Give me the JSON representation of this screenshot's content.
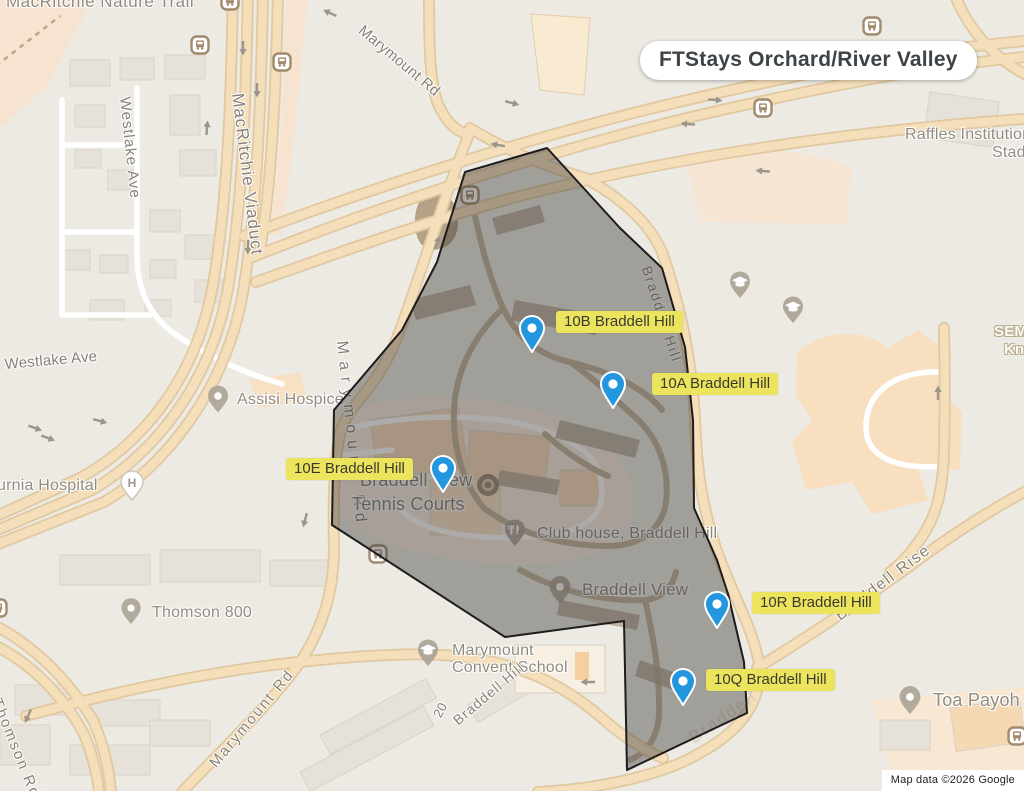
{
  "title": "FTStays Orchard/River Valley",
  "attribution": "Map data ©2026 Google",
  "markers": [
    {
      "id": "10B",
      "label": "10B Braddell Hill"
    },
    {
      "id": "10A",
      "label": "10A Braddell Hill"
    },
    {
      "id": "10E",
      "label": "10E Braddell Hill"
    },
    {
      "id": "10R",
      "label": "10R Braddell Hill"
    },
    {
      "id": "10Q",
      "label": "10Q Braddell Hill"
    }
  ],
  "map_labels": {
    "macritchie_nature_trail": "MacRitchie Nature Trail",
    "marymount_rd_top": "Marymount Rd",
    "macritchie_viaduct": "MacRitchie Viaduct",
    "westlake_ave_v": "Westlake Ave",
    "westlake_ave_h": "Westlake Ave",
    "raffles_institution": "Raffles Institution",
    "raffles_stadium": "Stadium",
    "sem_fragment": "SEM",
    "kni_fragment": "Kni",
    "assisi_hospice": "Assisi Hospice",
    "alvernia_hospital": "urnia Hospital",
    "thomson_800": "Thomson 800",
    "marymount_rd_mid": "Marymount Rd",
    "marymount_rd_bottom": "Marymount Rd",
    "thomson_rd": "Thomson Rd",
    "tennis_line1": "Braddell View",
    "tennis_line2": "Tennis Courts",
    "club_house": "Club house, Braddell Hill",
    "braddell_view": "Braddell View",
    "convent_line1": "Marymount",
    "convent_line2": "Convent School",
    "braddell_hill_road_south": "Braddell Hill",
    "braddell_hill_road_east": "Braddell Hill",
    "braddell_rise": "Braddell Rise",
    "braddell_road_fragment": "Braddell",
    "toa_payoh": "Toa Payoh",
    "building_20": "20"
  },
  "colors": {
    "marker_blue": "#2396e0",
    "marker_label_yellow": "#ece45c",
    "region_outline": "#1c1c1c",
    "road_fill": "#f4dfba",
    "background": "#edeae3"
  }
}
